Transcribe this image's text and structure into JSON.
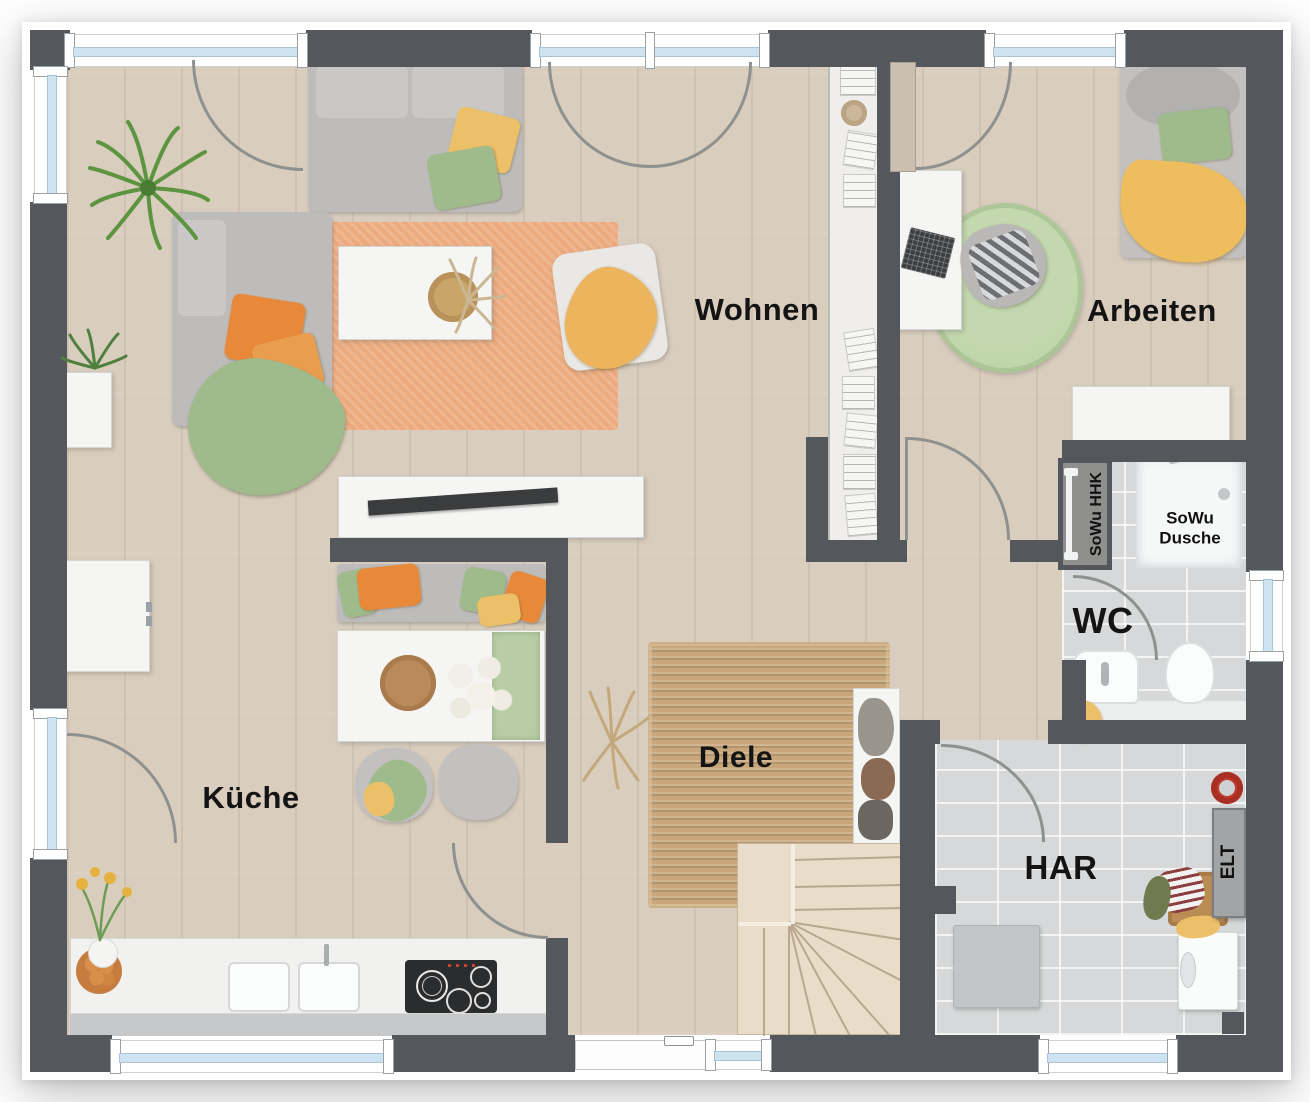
{
  "rooms": {
    "wohnen": {
      "label": "Wohnen"
    },
    "arbeiten": {
      "label": "Arbeiten"
    },
    "kueche": {
      "label": "Küche"
    },
    "diele": {
      "label": "Diele"
    },
    "wc": {
      "label": "WC"
    },
    "har": {
      "label": "HAR"
    }
  },
  "annotations": {
    "shower": {
      "line1": "SoWu",
      "line2": "Dusche"
    },
    "towel_radiator": {
      "label": "SoWu HHK"
    },
    "electrical": {
      "label": "ELT"
    }
  },
  "colors": {
    "wall": "#54585c",
    "floor_wood": "#d9cdbe",
    "floor_tile": "#d6d8d9",
    "rug_orange": "#ecaa7e",
    "rug_jute": "#c8a77d",
    "rug_green": "#b7cfa2",
    "glass": "#cfe2ef",
    "pillow_orange": "#e8893a",
    "pillow_green": "#9fba8b",
    "pillow_yellow": "#ecc068",
    "stair_wood": "#e9ddc9"
  }
}
